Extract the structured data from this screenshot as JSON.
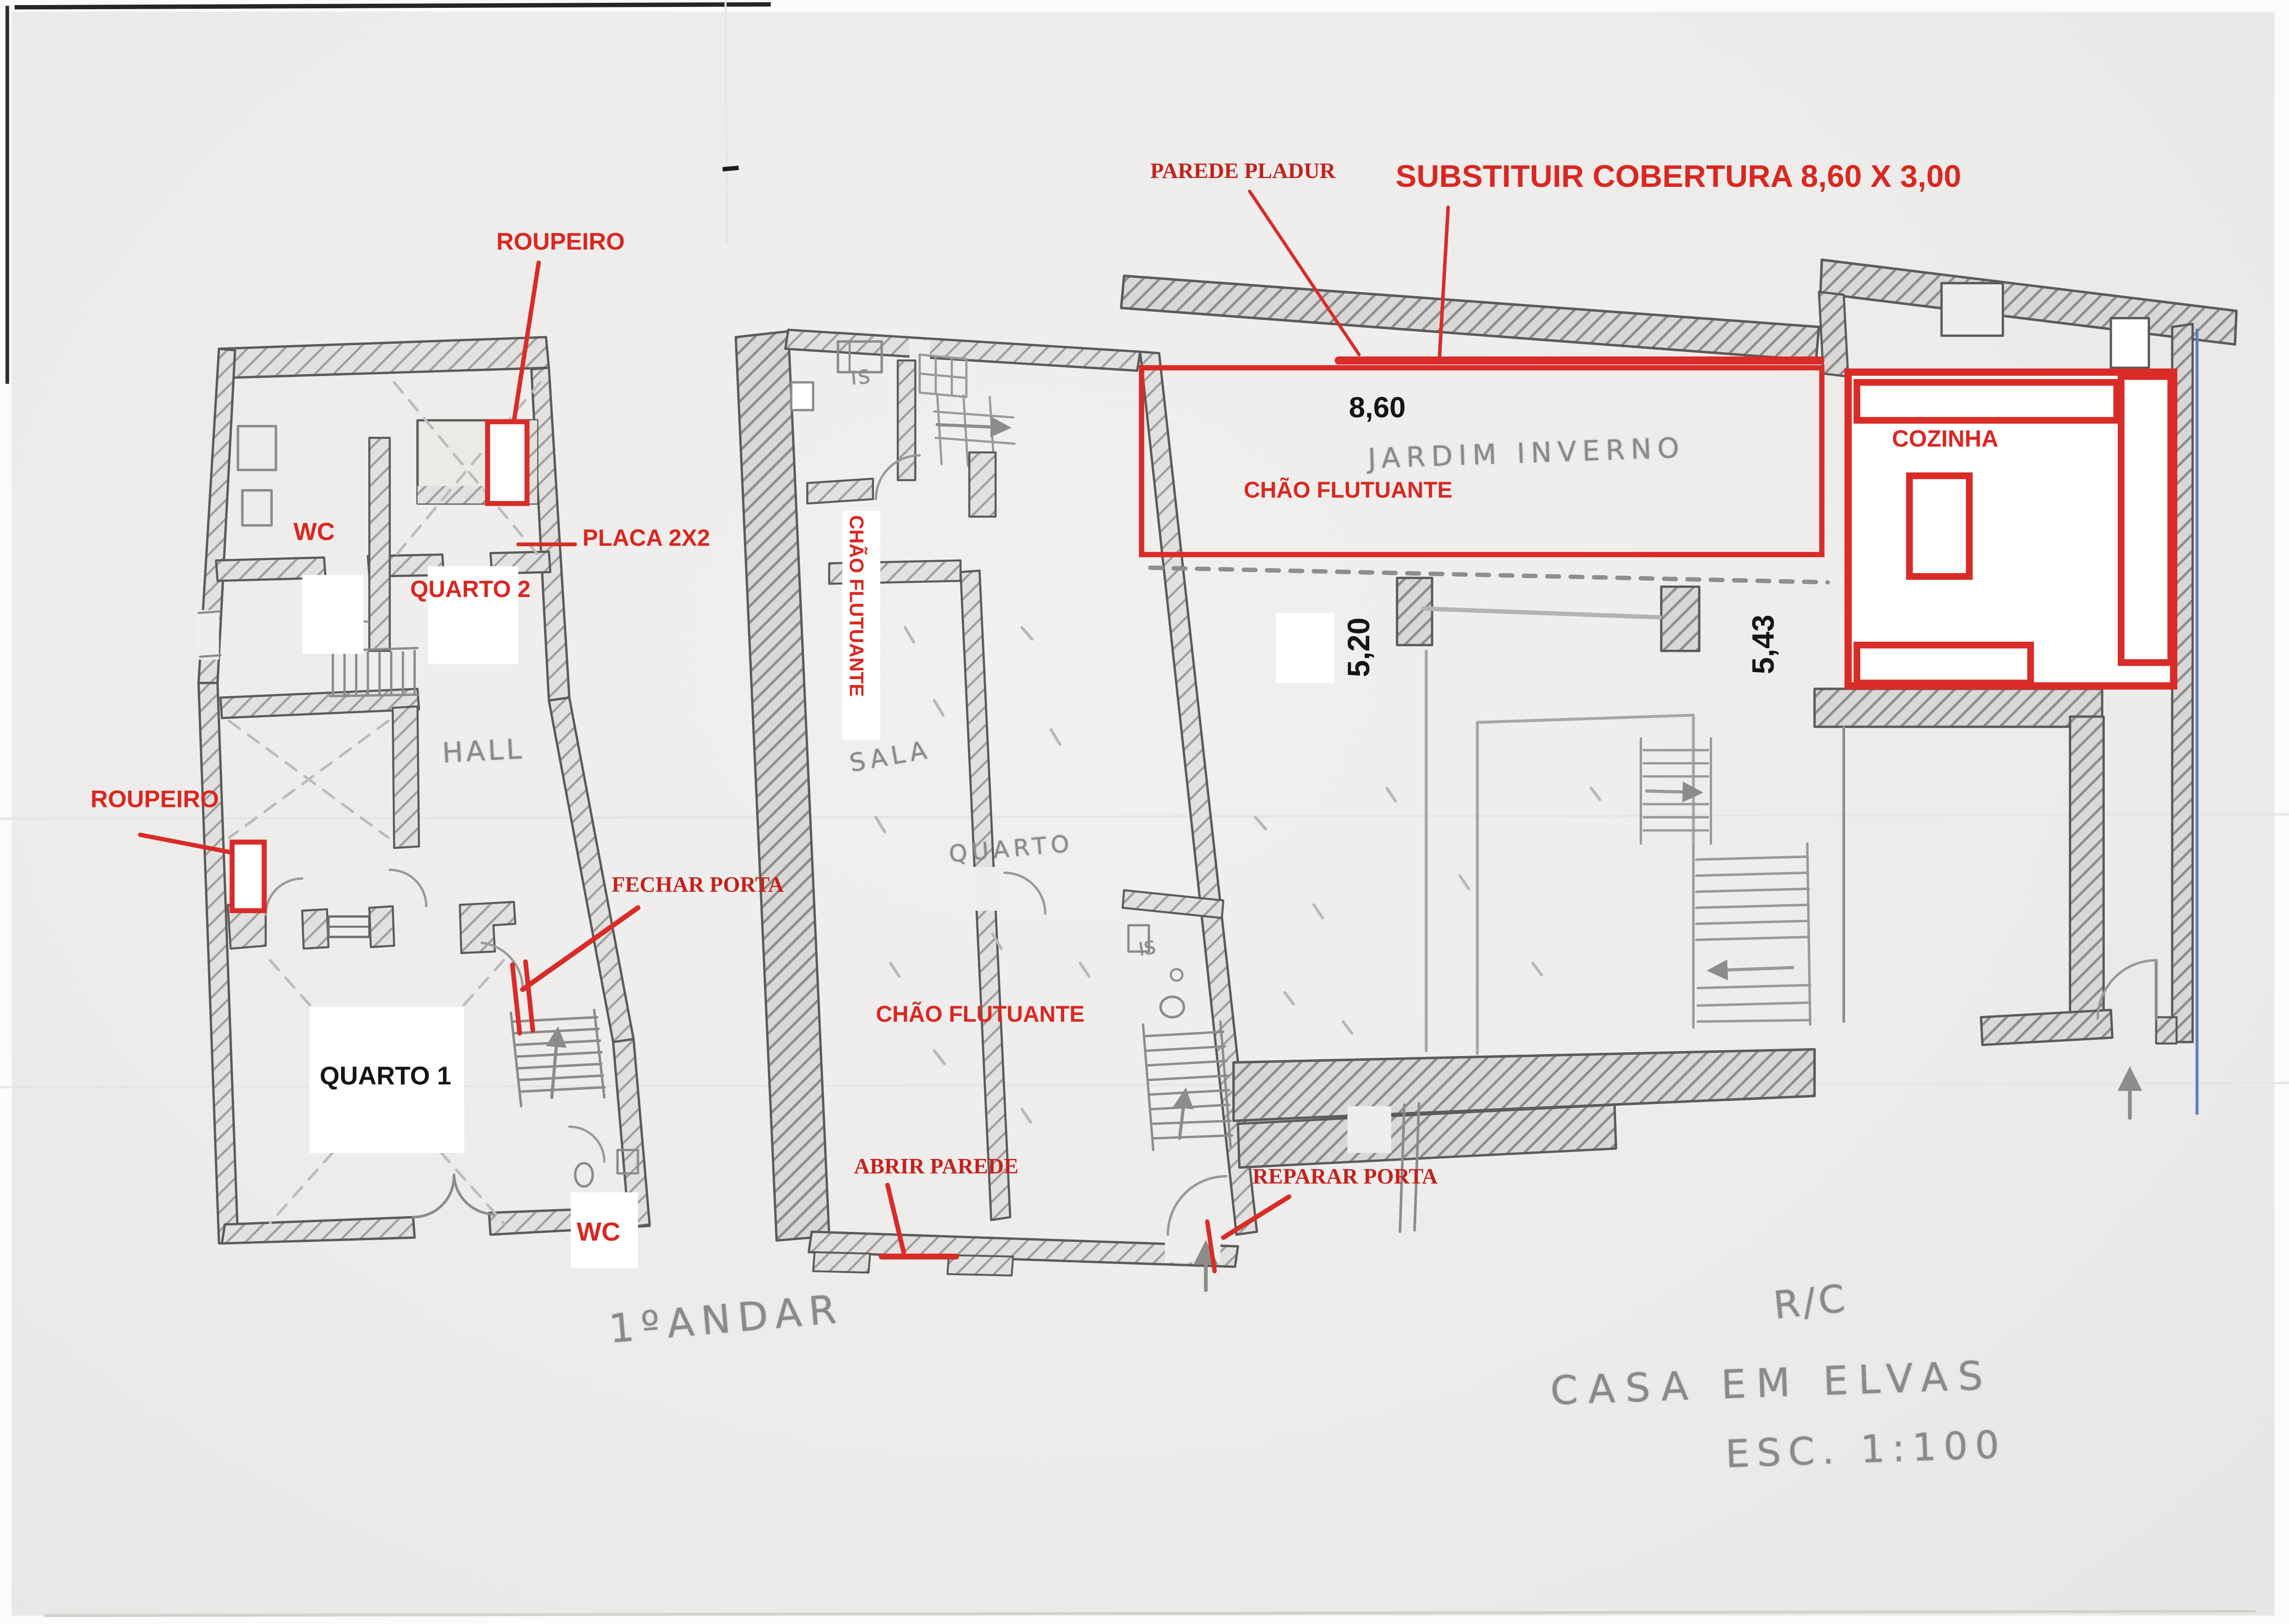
{
  "palette": {
    "annotation_red": "#da2721",
    "annotation_red_dark": "#c4211c",
    "pencil_gray": "#8b8a88",
    "ink_black": "#151515",
    "pen_blue": "#5b7fc4",
    "paper": "#efeeec"
  },
  "plan_first_floor": {
    "floor_label": "1ºANDAR",
    "room_labels": {
      "wc_top": "WC",
      "quarto2": "QUARTO 2",
      "hall": "HALL",
      "quarto1": "QUARTO 1",
      "wc_bottom": "WC"
    },
    "annotations": {
      "roupeiro_top": "ROUPEIRO",
      "placa_2x2": "PLACA 2X2",
      "roupeiro_left": "ROUPEIRO",
      "fechar_porta": "FECHAR PORTA"
    }
  },
  "plan_ground_floor": {
    "room_labels": {
      "is_top": "IS",
      "sala": "SALA",
      "quarto": "QUARTO",
      "is_mid": "IS",
      "jardim_inverno": "JARDIM INVERNO",
      "cozinha": "COZINHA"
    },
    "annotations": {
      "parede_pladur": "PAREDE PLADUR",
      "substituir_cobertura": "SUBSTITUIR COBERTURA 8,60 X 3,00",
      "chao_flutuante_corridor": "CHÃO FLUTUANTE",
      "chao_flutuante_room": "CHÃO FLUTUANTE",
      "chao_flutuante_jardim": "CHÃO FLUTUANTE",
      "abrir_parede": "ABRIR PAREDE",
      "reparar_porta": "REPARAR PORTA"
    },
    "dimensions": {
      "jardim_width": "8,60",
      "left_depth": "5,20",
      "right_depth": "5,43"
    }
  },
  "title_block": {
    "floor": "R/C",
    "project": "CASA EM ELVAS",
    "scale": "ESC. 1:100"
  }
}
